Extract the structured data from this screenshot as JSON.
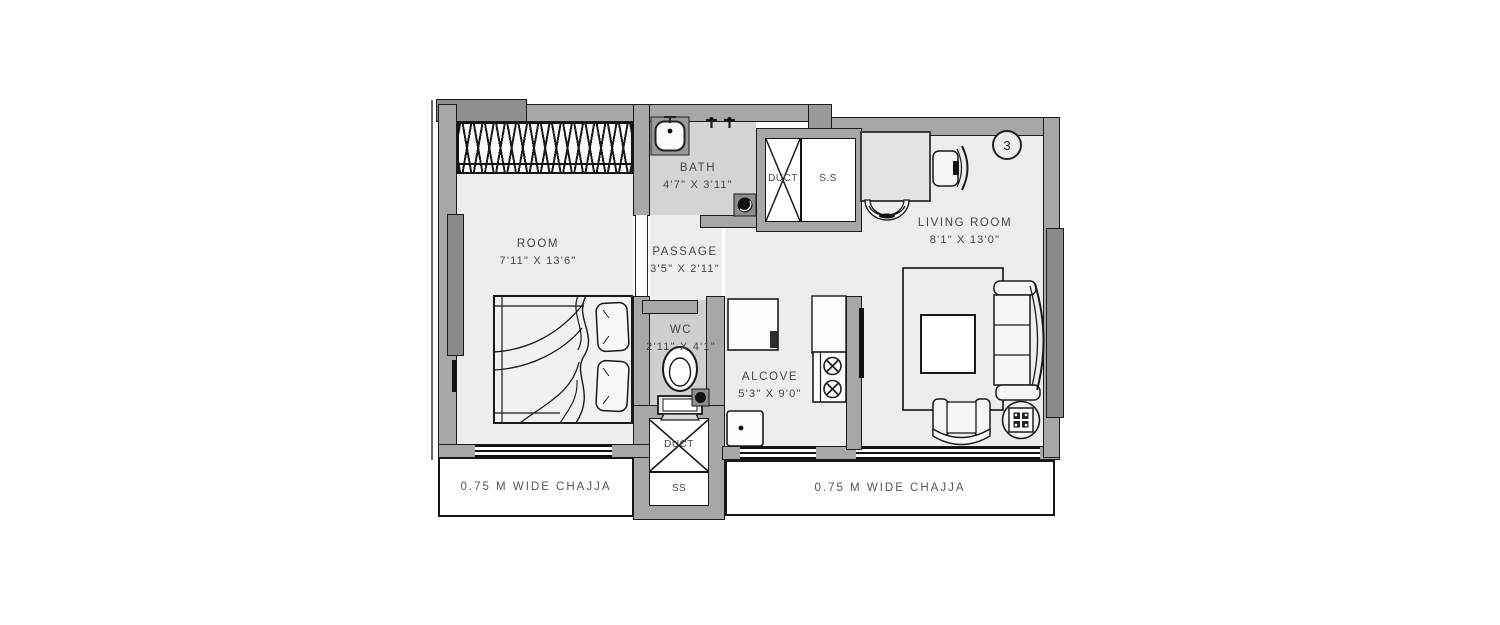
{
  "plan": {
    "unit_number": "3",
    "rooms": {
      "room": {
        "name": "ROOM",
        "dims": "7'11\" X 13'6\""
      },
      "bath": {
        "name": "BATH",
        "dims": "4'7\" X 3'11\""
      },
      "passage": {
        "name": "PASSAGE",
        "dims": "3'5\" X 2'11\""
      },
      "wc": {
        "name": "WC",
        "dims": "2'11\" X 4'1\""
      },
      "alcove": {
        "name": "ALCOVE",
        "dims": "5'3\" X 9'0\""
      },
      "living_room": {
        "name": "LIVING ROOM",
        "dims": "8'1\" X 13'0\""
      }
    },
    "shafts": {
      "duct_top": "DUCT",
      "ss_top": "S.S",
      "duct_bottom": "DUCT",
      "ss_bottom": "SS"
    },
    "chajja": {
      "left": "0.75 M WIDE CHAJJA",
      "right": "0.75 M WIDE CHAJJA"
    },
    "colors": {
      "floor": "#ededed",
      "wet_floor": "#d4d4d4",
      "wall": "#a7a7a7",
      "wall_dark": "#8a8a8a",
      "line": "#111111",
      "canvas": "#ffffff"
    }
  }
}
